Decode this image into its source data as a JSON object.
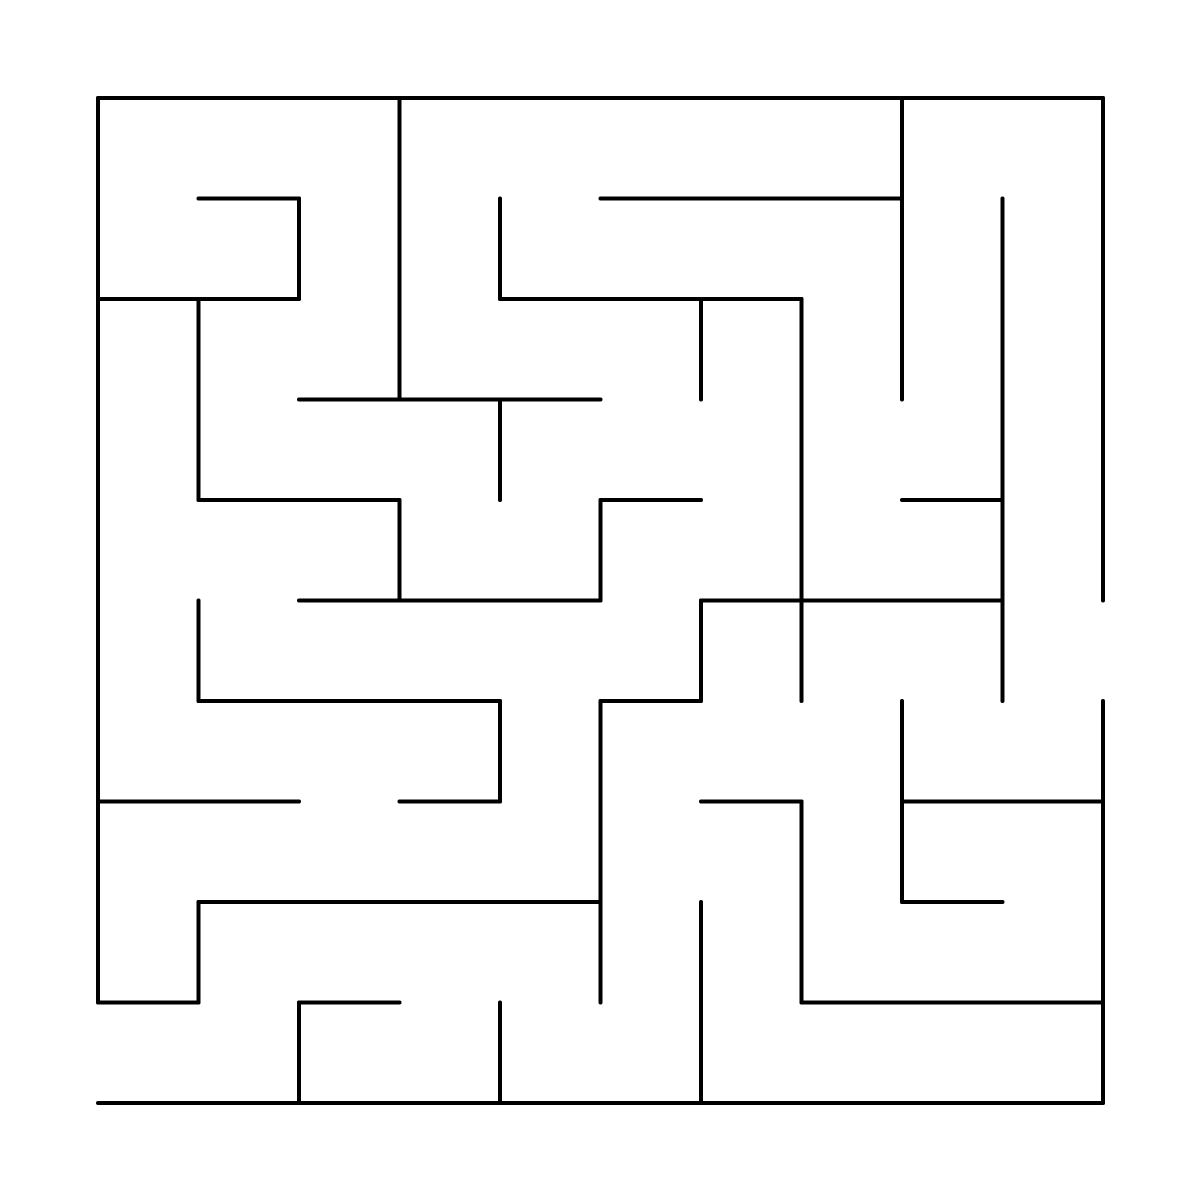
{
  "page": {
    "background_color": "#ffffff",
    "width": 1200,
    "height": 1200
  },
  "maze": {
    "type": "maze-puzzle",
    "grid": {
      "cols": 10,
      "rows": 10
    },
    "layout": {
      "origin_x": 98,
      "origin_y": 98,
      "cell_size": 100.5
    },
    "style": {
      "wall_color": "#000000",
      "wall_width": 4,
      "linecap": "round"
    },
    "openings": [
      {
        "side": "left",
        "row": 9
      },
      {
        "side": "right",
        "row": 5
      }
    ],
    "walls": [
      {
        "x1": 0,
        "y1": 0,
        "x2": 10,
        "y2": 0
      },
      {
        "x1": 1,
        "y1": 1,
        "x2": 2,
        "y2": 1
      },
      {
        "x1": 5,
        "y1": 1,
        "x2": 8,
        "y2": 1
      },
      {
        "x1": 0,
        "y1": 2,
        "x2": 2,
        "y2": 2
      },
      {
        "x1": 4,
        "y1": 2,
        "x2": 7,
        "y2": 2
      },
      {
        "x1": 2,
        "y1": 3,
        "x2": 5,
        "y2": 3
      },
      {
        "x1": 1,
        "y1": 4,
        "x2": 3,
        "y2": 4
      },
      {
        "x1": 5,
        "y1": 4,
        "x2": 6,
        "y2": 4
      },
      {
        "x1": 8,
        "y1": 4,
        "x2": 9,
        "y2": 4
      },
      {
        "x1": 2,
        "y1": 5,
        "x2": 5,
        "y2": 5
      },
      {
        "x1": 6,
        "y1": 5,
        "x2": 9,
        "y2": 5
      },
      {
        "x1": 1,
        "y1": 6,
        "x2": 4,
        "y2": 6
      },
      {
        "x1": 5,
        "y1": 6,
        "x2": 6,
        "y2": 6
      },
      {
        "x1": 0,
        "y1": 7,
        "x2": 2,
        "y2": 7
      },
      {
        "x1": 3,
        "y1": 7,
        "x2": 4,
        "y2": 7
      },
      {
        "x1": 6,
        "y1": 7,
        "x2": 7,
        "y2": 7
      },
      {
        "x1": 8,
        "y1": 7,
        "x2": 10,
        "y2": 7
      },
      {
        "x1": 1,
        "y1": 8,
        "x2": 5,
        "y2": 8
      },
      {
        "x1": 8,
        "y1": 8,
        "x2": 9,
        "y2": 8
      },
      {
        "x1": 0,
        "y1": 9,
        "x2": 1,
        "y2": 9
      },
      {
        "x1": 2,
        "y1": 9,
        "x2": 3,
        "y2": 9
      },
      {
        "x1": 7,
        "y1": 9,
        "x2": 10,
        "y2": 9
      },
      {
        "x1": 0,
        "y1": 10,
        "x2": 10,
        "y2": 10
      },
      {
        "x1": 0,
        "y1": 0,
        "x2": 0,
        "y2": 9
      },
      {
        "x1": 1,
        "y1": 2,
        "x2": 1,
        "y2": 4
      },
      {
        "x1": 1,
        "y1": 5,
        "x2": 1,
        "y2": 6
      },
      {
        "x1": 1,
        "y1": 8,
        "x2": 1,
        "y2": 9
      },
      {
        "x1": 2,
        "y1": 1,
        "x2": 2,
        "y2": 2
      },
      {
        "x1": 2,
        "y1": 9,
        "x2": 2,
        "y2": 10
      },
      {
        "x1": 3,
        "y1": 0,
        "x2": 3,
        "y2": 3
      },
      {
        "x1": 3,
        "y1": 4,
        "x2": 3,
        "y2": 5
      },
      {
        "x1": 4,
        "y1": 1,
        "x2": 4,
        "y2": 2
      },
      {
        "x1": 4,
        "y1": 3,
        "x2": 4,
        "y2": 4
      },
      {
        "x1": 4,
        "y1": 6,
        "x2": 4,
        "y2": 7
      },
      {
        "x1": 4,
        "y1": 9,
        "x2": 4,
        "y2": 10
      },
      {
        "x1": 5,
        "y1": 4,
        "x2": 5,
        "y2": 5
      },
      {
        "x1": 5,
        "y1": 6,
        "x2": 5,
        "y2": 9
      },
      {
        "x1": 6,
        "y1": 2,
        "x2": 6,
        "y2": 3
      },
      {
        "x1": 6,
        "y1": 5,
        "x2": 6,
        "y2": 6
      },
      {
        "x1": 6,
        "y1": 8,
        "x2": 6,
        "y2": 10
      },
      {
        "x1": 7,
        "y1": 2,
        "x2": 7,
        "y2": 6
      },
      {
        "x1": 7,
        "y1": 7,
        "x2": 7,
        "y2": 9
      },
      {
        "x1": 8,
        "y1": 0,
        "x2": 8,
        "y2": 3
      },
      {
        "x1": 8,
        "y1": 6,
        "x2": 8,
        "y2": 8
      },
      {
        "x1": 9,
        "y1": 1,
        "x2": 9,
        "y2": 6
      },
      {
        "x1": 10,
        "y1": 0,
        "x2": 10,
        "y2": 5
      },
      {
        "x1": 10,
        "y1": 6,
        "x2": 10,
        "y2": 10
      }
    ]
  }
}
